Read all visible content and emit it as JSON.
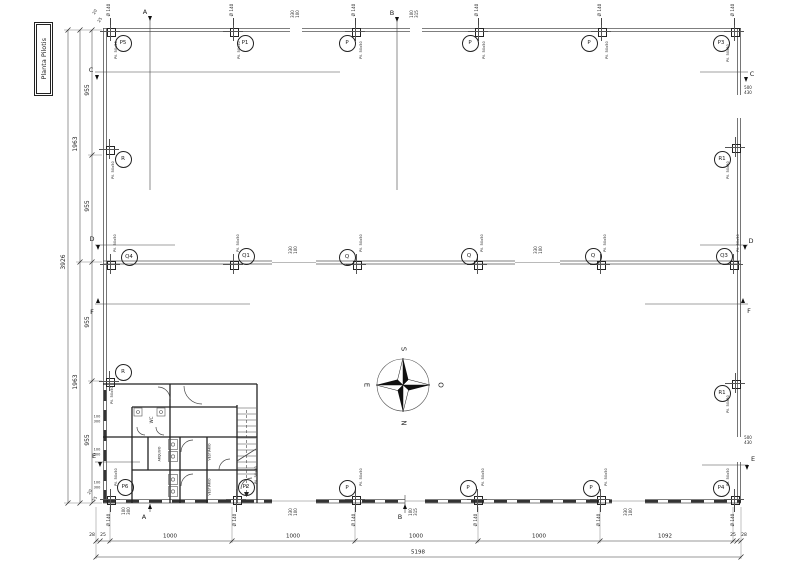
{
  "title_block": {
    "text": "Planta Pilotis"
  },
  "compass": {
    "south": "S",
    "west_pt": "O",
    "north": "N",
    "east_pt": "E"
  },
  "pillar_type_label": "Pil. 50x50",
  "diameter_label": "Ø 140",
  "pillars": [
    {
      "label": "P5",
      "sx": 110,
      "sy": 31,
      "cx": 122,
      "cy": 42,
      "px": 117,
      "py": 50,
      "dia": "above"
    },
    {
      "label": "P1",
      "sx": 233,
      "sy": 31,
      "cx": 244,
      "cy": 42,
      "px": 240,
      "py": 50,
      "dia": "above"
    },
    {
      "label": "P",
      "sx": 355,
      "sy": 31,
      "cx": 346,
      "cy": 42,
      "px": 362,
      "py": 50,
      "dia": "above"
    },
    {
      "label": "P",
      "sx": 478,
      "sy": 31,
      "cx": 469,
      "cy": 42,
      "px": 485,
      "py": 50,
      "dia": "above"
    },
    {
      "label": "P",
      "sx": 601,
      "sy": 31,
      "cx": 588,
      "cy": 42,
      "px": 608,
      "py": 50,
      "dia": "above"
    },
    {
      "label": "P3",
      "sx": 734,
      "sy": 31,
      "cx": 720,
      "cy": 42,
      "px": 729,
      "py": 53,
      "dia": "above"
    },
    {
      "label": "R",
      "sx": 109,
      "sy": 149,
      "cx": 122,
      "cy": 158,
      "px": 114,
      "py": 170,
      "dia": "none"
    },
    {
      "label": "R1",
      "sx": 735,
      "sy": 147,
      "cx": 721,
      "cy": 158,
      "px": 729,
      "py": 170,
      "dia": "none"
    },
    {
      "label": "Q4",
      "sx": 110,
      "sy": 264,
      "cx": 128,
      "cy": 256,
      "px": 116,
      "py": 243,
      "dia": "none"
    },
    {
      "label": "Q1",
      "sx": 233,
      "sy": 264,
      "cx": 245,
      "cy": 255,
      "px": 239,
      "py": 243,
      "dia": "none"
    },
    {
      "label": "Q",
      "sx": 356,
      "sy": 264,
      "cx": 346,
      "cy": 256,
      "px": 362,
      "py": 243,
      "dia": "none"
    },
    {
      "label": "Q",
      "sx": 477,
      "sy": 264,
      "cx": 468,
      "cy": 255,
      "px": 483,
      "py": 243,
      "dia": "none"
    },
    {
      "label": "Q",
      "sx": 600,
      "sy": 264,
      "cx": 592,
      "cy": 255,
      "px": 606,
      "py": 243,
      "dia": "none"
    },
    {
      "label": "Q3",
      "sx": 733,
      "sy": 264,
      "cx": 723,
      "cy": 255,
      "px": 739,
      "py": 243,
      "dia": "none"
    },
    {
      "label": "R",
      "sx": 109,
      "sy": 381,
      "cx": 122,
      "cy": 371,
      "px": 113,
      "py": 395,
      "dia": "none"
    },
    {
      "label": "R1",
      "sx": 735,
      "sy": 383,
      "cx": 721,
      "cy": 392,
      "px": 729,
      "py": 404,
      "dia": "none"
    },
    {
      "label": "P6",
      "sx": 110,
      "sy": 499,
      "cx": 124,
      "cy": 486,
      "px": 117,
      "py": 477,
      "dia": "below"
    },
    {
      "label": "P2",
      "sx": 236,
      "sy": 499,
      "cx": 245,
      "cy": 486,
      "px": 257,
      "py": 475,
      "dia": "below"
    },
    {
      "label": "P",
      "sx": 355,
      "sy": 499,
      "cx": 346,
      "cy": 487,
      "px": 362,
      "py": 477,
      "dia": "below"
    },
    {
      "label": "P",
      "sx": 477,
      "sy": 499,
      "cx": 467,
      "cy": 487,
      "px": 484,
      "py": 477,
      "dia": "below"
    },
    {
      "label": "P",
      "sx": 600,
      "sy": 499,
      "cx": 590,
      "cy": 487,
      "px": 607,
      "py": 477,
      "dia": "below"
    },
    {
      "label": "P4",
      "sx": 734,
      "sy": 499,
      "cx": 720,
      "cy": 487,
      "px": 729,
      "py": 477,
      "dia": "below"
    }
  ],
  "section_markers": [
    {
      "letter": "A",
      "x": 145,
      "y": 12,
      "dir": "down",
      "ax": 150,
      "ay": 18
    },
    {
      "letter": "B",
      "x": 392,
      "y": 13,
      "dir": "down",
      "ax": 397,
      "ay": 19
    },
    {
      "letter": "A",
      "x": 144,
      "y": 517,
      "dir": "up",
      "ax": 150,
      "ay": 506
    },
    {
      "letter": "B",
      "x": 400,
      "y": 517,
      "dir": "up",
      "ax": 405,
      "ay": 506
    },
    {
      "letter": "C",
      "x": 91,
      "y": 70,
      "dir": "down",
      "ax": 97,
      "ay": 77
    },
    {
      "letter": "C",
      "x": 752,
      "y": 74,
      "dir": "down",
      "ax": 746,
      "ay": 79
    },
    {
      "letter": "D",
      "x": 92,
      "y": 239,
      "dir": "down",
      "ax": 98,
      "ay": 247
    },
    {
      "letter": "D",
      "x": 751,
      "y": 241,
      "dir": "down",
      "ax": 745,
      "ay": 247
    },
    {
      "letter": "F",
      "x": 92,
      "y": 312,
      "dir": "up",
      "ax": 98,
      "ay": 300
    },
    {
      "letter": "F",
      "x": 749,
      "y": 311,
      "dir": "up",
      "ax": 743,
      "ay": 300
    },
    {
      "letter": "E",
      "x": 94,
      "y": 456,
      "dir": "down",
      "ax": 100,
      "ay": 464
    },
    {
      "letter": "E",
      "x": 753,
      "y": 459,
      "dir": "down",
      "ax": 747,
      "ay": 467
    }
  ],
  "dim_labels": [
    {
      "t": "3926",
      "x": 64,
      "y": 262,
      "r": -90,
      "s": 6
    },
    {
      "t": "1963",
      "x": 76,
      "y": 144,
      "r": -90,
      "s": 6
    },
    {
      "t": "1963",
      "x": 76,
      "y": 382,
      "r": -90,
      "s": 6
    },
    {
      "t": "955",
      "x": 88,
      "y": 90,
      "r": -90,
      "s": 6
    },
    {
      "t": "955",
      "x": 88,
      "y": 206,
      "r": -90,
      "s": 6
    },
    {
      "t": "955",
      "x": 88,
      "y": 322,
      "r": -90,
      "s": 6
    },
    {
      "t": "955",
      "x": 88,
      "y": 440,
      "r": -90,
      "s": 6
    },
    {
      "t": "28",
      "x": 92,
      "y": 536,
      "r": 0,
      "s": 4.5
    },
    {
      "t": "25",
      "x": 103,
      "y": 536,
      "r": 0,
      "s": 4.5
    },
    {
      "t": "1000",
      "x": 170,
      "y": 537,
      "r": 0,
      "s": 5.5
    },
    {
      "t": "1000",
      "x": 293,
      "y": 537,
      "r": 0,
      "s": 5.5
    },
    {
      "t": "1000",
      "x": 416,
      "y": 537,
      "r": 0,
      "s": 5.5
    },
    {
      "t": "1000",
      "x": 539,
      "y": 537,
      "r": 0,
      "s": 5.5
    },
    {
      "t": "1092",
      "x": 665,
      "y": 537,
      "r": 0,
      "s": 5.5
    },
    {
      "t": "25",
      "x": 733,
      "y": 536,
      "r": 0,
      "s": 4.5
    },
    {
      "t": "28",
      "x": 744,
      "y": 536,
      "r": 0,
      "s": 4.5
    },
    {
      "t": "5198",
      "x": 418,
      "y": 553,
      "r": 0,
      "s": 5.5
    },
    {
      "t": "20",
      "x": 95,
      "y": 12,
      "r": -60,
      "s": 4
    },
    {
      "t": "25",
      "x": 100,
      "y": 20,
      "r": -60,
      "s": 4
    },
    {
      "t": "20",
      "x": 90,
      "y": 492,
      "r": -60,
      "s": 4
    },
    {
      "t": "25",
      "x": 95,
      "y": 499,
      "r": -60,
      "s": 4
    },
    {
      "t": "330",
      "x": 293,
      "y": 14,
      "r": -90,
      "s": 4
    },
    {
      "t": "100",
      "x": 298,
      "y": 14,
      "r": -90,
      "s": 4
    },
    {
      "t": "100",
      "x": 412,
      "y": 14,
      "r": -90,
      "s": 4
    },
    {
      "t": "315",
      "x": 417,
      "y": 14,
      "r": -90,
      "s": 4
    },
    {
      "t": "330",
      "x": 291,
      "y": 250,
      "r": -90,
      "s": 4
    },
    {
      "t": "100",
      "x": 296,
      "y": 250,
      "r": -90,
      "s": 4
    },
    {
      "t": "330",
      "x": 536,
      "y": 250,
      "r": -90,
      "s": 4
    },
    {
      "t": "100",
      "x": 541,
      "y": 250,
      "r": -90,
      "s": 4
    },
    {
      "t": "100",
      "x": 124,
      "y": 511,
      "r": -90,
      "s": 4
    },
    {
      "t": "300",
      "x": 129,
      "y": 511,
      "r": -90,
      "s": 4
    },
    {
      "t": "330",
      "x": 291,
      "y": 512,
      "r": -90,
      "s": 4
    },
    {
      "t": "100",
      "x": 296,
      "y": 512,
      "r": -90,
      "s": 4
    },
    {
      "t": "100",
      "x": 411,
      "y": 512,
      "r": -90,
      "s": 4
    },
    {
      "t": "315",
      "x": 416,
      "y": 512,
      "r": -90,
      "s": 4
    },
    {
      "t": "330",
      "x": 626,
      "y": 512,
      "r": -90,
      "s": 4
    },
    {
      "t": "100",
      "x": 631,
      "y": 512,
      "r": -90,
      "s": 4
    },
    {
      "t": "500",
      "x": 748,
      "y": 88,
      "r": 0,
      "s": 4
    },
    {
      "t": "430",
      "x": 748,
      "y": 93,
      "r": 0,
      "s": 4
    },
    {
      "t": "500",
      "x": 748,
      "y": 438,
      "r": 0,
      "s": 4
    },
    {
      "t": "430",
      "x": 748,
      "y": 443,
      "r": 0,
      "s": 4
    },
    {
      "t": "100",
      "x": 97,
      "y": 417,
      "r": 0,
      "s": 3.5
    },
    {
      "t": "300",
      "x": 97,
      "y": 422,
      "r": 0,
      "s": 3.5
    },
    {
      "t": "100",
      "x": 97,
      "y": 450,
      "r": 0,
      "s": 3.5
    },
    {
      "t": "300",
      "x": 97,
      "y": 455,
      "r": 0,
      "s": 3.5
    },
    {
      "t": "100",
      "x": 97,
      "y": 483,
      "r": 0,
      "s": 3.5
    },
    {
      "t": "300",
      "x": 97,
      "y": 488,
      "r": 0,
      "s": 3.5
    }
  ],
  "room_labels": [
    {
      "t": "WC",
      "x": 152,
      "y": 420,
      "r": -90,
      "s": 4
    },
    {
      "t": "ARQUIVO",
      "x": 160,
      "y": 454,
      "r": -90,
      "s": 3.2
    },
    {
      "t": "VESTIÁRIO",
      "x": 210,
      "y": 452,
      "r": -90,
      "s": 3.2
    },
    {
      "t": "VESTIÁRIO",
      "x": 210,
      "y": 487,
      "r": -90,
      "s": 3.2
    }
  ]
}
